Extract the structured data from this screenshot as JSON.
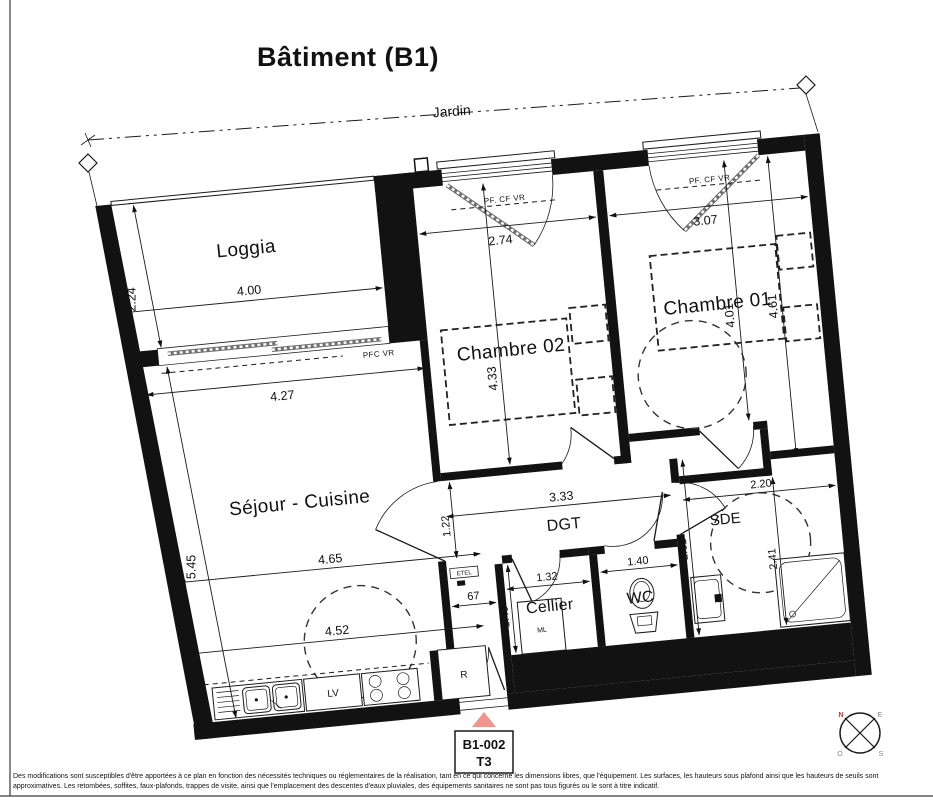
{
  "page": {
    "title": "Bâtiment (B1)",
    "garden_label": "Jardin",
    "accent_color": "#f2948c",
    "disclaimer_line1": "Des modifications sont susceptibles d'être apportées à ce plan en fonction des nécessités techniques ou réglementaires de la réalisation, tant en ce qui concerne les dimensions libres, que l'équipement. Les surfaces, les hauteurs sous plafond ainsi que les hauteurs de seuils sont",
    "disclaimer_line2": "approximatives. Les retombées, soffites, faux-plafonds, trappes de visite, ainsi que l'emplacement des descentes d'eaux pluviales, des équipements sanitaires ne sont pas tous figurés ou le sont à titre indicatif."
  },
  "unit_tag": {
    "ref": "B1-002",
    "type": "T3"
  },
  "compass": {
    "north": "N",
    "east": "E",
    "south": "S",
    "west": "O"
  },
  "rooms": {
    "loggia": {
      "name": "Loggia",
      "width": "4.00",
      "depth": "2.24",
      "door_width": "4.27",
      "window_label": "PFC VR"
    },
    "chambre02": {
      "name": "Chambre 02",
      "width": "2.74",
      "depth": "4.33",
      "window_label": "PF. CF VR"
    },
    "chambre01": {
      "name": "Chambre 01",
      "width": "3.07",
      "depth": "4.01",
      "depth2": "4.61",
      "window_label": "PF. CF VR"
    },
    "sejour": {
      "name": "Séjour - Cuisine",
      "depth": "5.45",
      "width1": "4.65",
      "width2": "4.52"
    },
    "dgt": {
      "name": "DGT",
      "length": "3.33",
      "width": "1.22"
    },
    "cellier": {
      "name": "Cellier",
      "width": "1.32",
      "depth": "1.40"
    },
    "wc": {
      "name": "WC",
      "width": "1.40"
    },
    "sde": {
      "name": "SDE",
      "width": "2.20",
      "depth": "2.41",
      "height_left": "2.61"
    },
    "entry": {
      "width": "67"
    }
  },
  "fixtures": {
    "dishwasher": "LV",
    "fridge": "R",
    "washing_machine": "ML",
    "electrical_panel": "ETEL"
  }
}
